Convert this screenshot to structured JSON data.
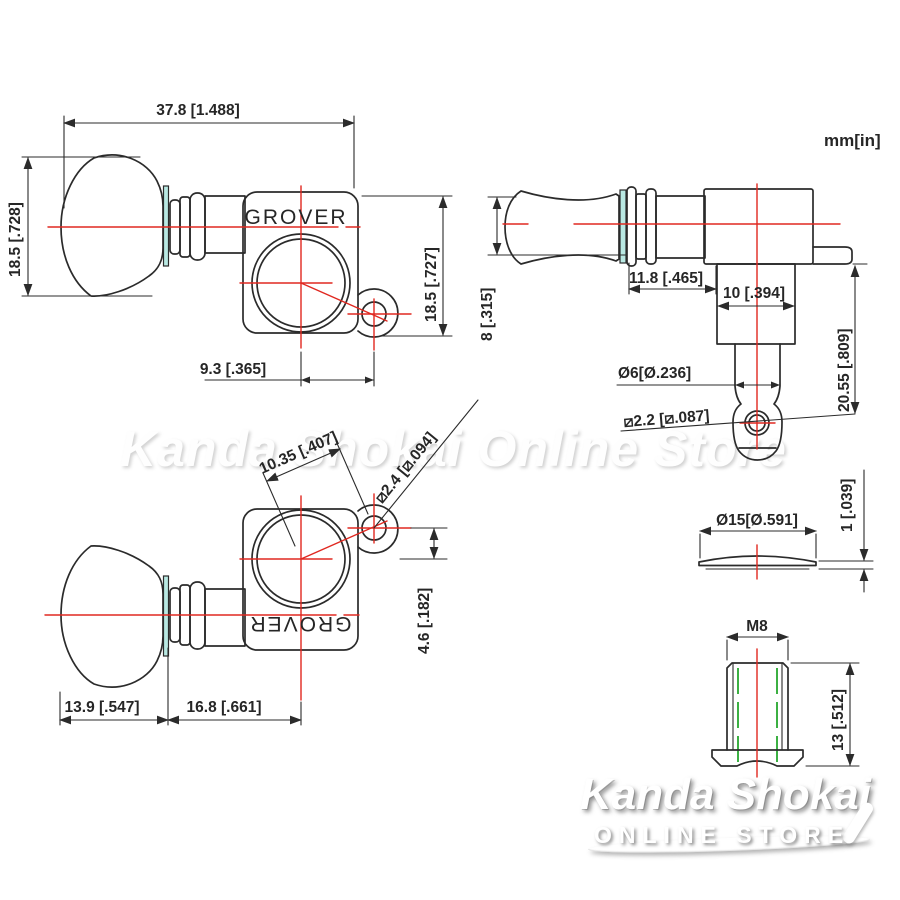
{
  "units_label": "mm[in]",
  "brand": "GROVER",
  "watermark_text": "Kanda Shokai Online Store",
  "logo": {
    "title": "Kanda Shokai",
    "subtitle": "ONLINE STORE"
  },
  "colors": {
    "line": "#2b2b2b",
    "centerline_red": "#e02820",
    "brand_teal": "#7cc9ae",
    "joint_cyan": "#b9e9e3",
    "thread_green": "#3cb043",
    "background": "#ffffff"
  },
  "views": {
    "front_top": {
      "dim_total_width": "37.8 [1.488]",
      "dim_button_height": "18.5 [.728]",
      "dim_body_height": "18.5 [.727]",
      "dim_screw_offset_x": "9.3 [.365]"
    },
    "side": {
      "dim_button_thickness": "8 [.315]",
      "dim_shaft_length": "11.8 [.465]",
      "dim_collar_width": "10 [.394]",
      "dim_post_length": "20.55 [.809]",
      "dim_post_diameter": "Ø6[Ø.236]",
      "dim_string_hole_diameter": "⧄2.2 [⧄.087]"
    },
    "front_bottom": {
      "dim_diagonal_offset": "10.35 [.407]",
      "dim_screw_hole_diameter": "⧄2.4 [⧄.094]",
      "dim_screw_offset_y": "4.6 [.182]",
      "dim_button_length": "13.9 [.547]",
      "dim_shaft_to_center": "16.8 [.661]"
    },
    "washer": {
      "dim_diameter": "Ø15[Ø.591]",
      "dim_thickness": "1 [.039]"
    },
    "bushing": {
      "dim_thread": "M8",
      "dim_height": "13 [.512]"
    }
  }
}
